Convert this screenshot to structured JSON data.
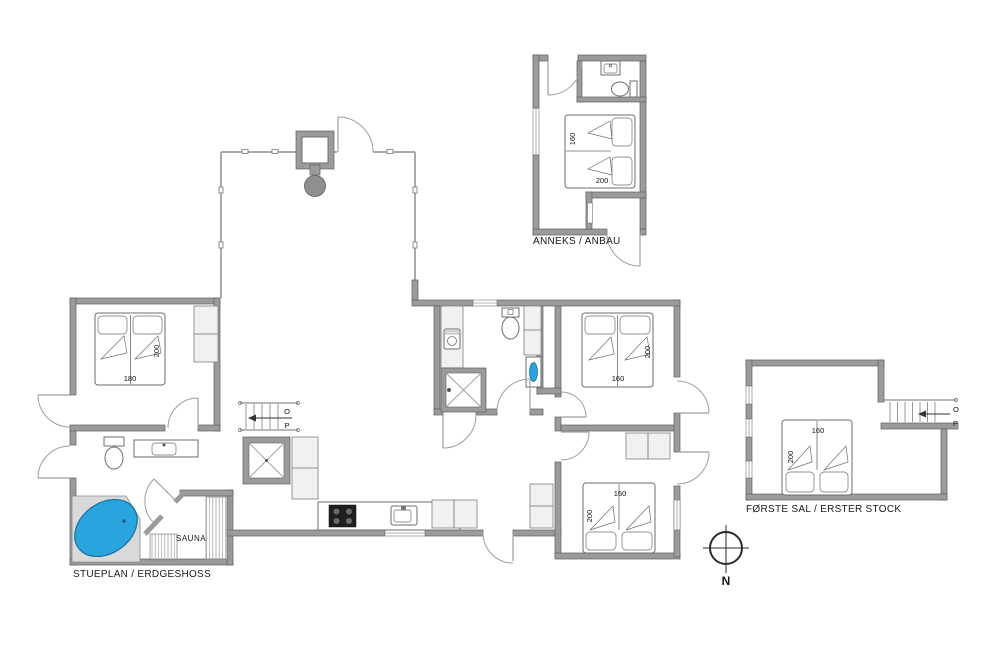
{
  "labels": {
    "annex": "ANNEKS / ANBAU",
    "ground_floor": "STUEPLAN / ERDGESHOSS",
    "first_floor": "FØRSTE SAL / ERSTER STOCK",
    "sauna": "SAUNA",
    "north": "N"
  },
  "stairs": {
    "up": "O",
    "down": "P"
  },
  "beds": {
    "annex": {
      "width": "160",
      "length": "200"
    },
    "left_bedroom": {
      "width": "180",
      "length": "200"
    },
    "right_top_bedroom": {
      "width": "160",
      "length": "200"
    },
    "right_bottom_bedroom": {
      "width": "160",
      "length": "200"
    },
    "first_floor": {
      "width": "160",
      "length": "200"
    }
  },
  "colors": {
    "hot_tub": "#2aa4de",
    "basin": "#2aa4de",
    "cooktop": "#1f1f1f"
  }
}
